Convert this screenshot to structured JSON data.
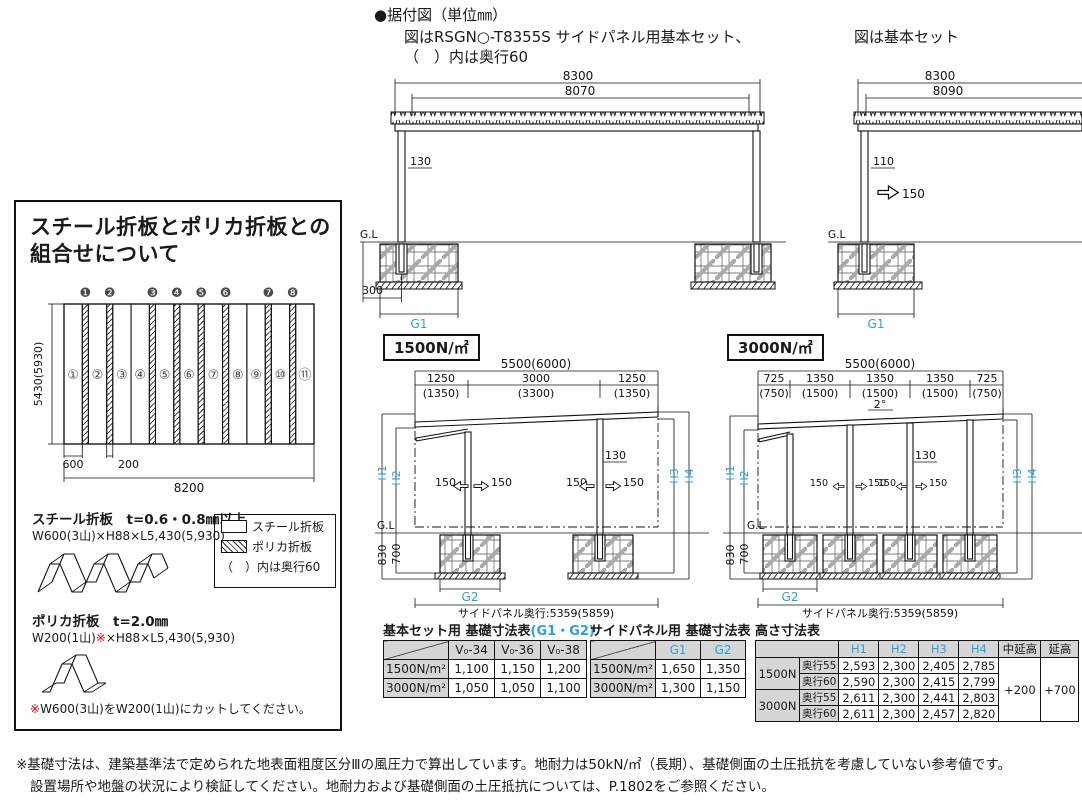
{
  "header": {
    "title": "●据付図（単位㎜）",
    "caption1a": "図はRSGN○-T8355S サイドパネル用基本セット、",
    "caption1b": "（　）内は奥行60",
    "caption2": "図は基本セット"
  },
  "combo": {
    "title1": "スチール折板とポリカ折板との",
    "title2": "組合せについて",
    "dim_height": "5430(5930)",
    "dim_600": "600",
    "dim_200": "200",
    "dim_8200": "8200",
    "steel_nums": [
      "①",
      "②",
      "③",
      "④",
      "⑤",
      "⑥",
      "⑦",
      "⑧",
      "⑨",
      "⑩",
      "⑪"
    ],
    "poly_nums": [
      "❶",
      "❷",
      "❸",
      "❹",
      "❺",
      "❻",
      "❼",
      "❽"
    ],
    "steel_title": "スチール折板　t=0.6・0.8㎜以上",
    "steel_spec": "W600(3山)×H88×L5,430(5,930)",
    "poly_title": "ポリカ折板　t=2.0㎜",
    "poly_spec_pre": "W200(1山)",
    "poly_spec_mark": "※",
    "poly_spec_post": "×H88×L5,430(5,930)",
    "legend_steel": "スチール折板",
    "legend_poly": "ポリカ折板",
    "legend_note": "（　）内は奥行60",
    "cut_mark": "※",
    "cut_note": "W600(3山)をW200(1山)にカットしてください。"
  },
  "elev_sp": {
    "dim_total": "8300",
    "dim_roof": "8070",
    "dim_gap": "130",
    "gl": "G.L",
    "dim_offset": "300",
    "g1": "G1"
  },
  "elev_basic": {
    "dim_total": "8300",
    "dim_roof": "8090",
    "dim_gap": "110",
    "wind": "150",
    "gl": "G.L",
    "g1": "G1"
  },
  "sec1500": {
    "badge": "1500N/㎡",
    "dim_total": "5500(6000)",
    "seg": [
      "1250",
      "3000",
      "1250"
    ],
    "seg_paren": [
      "(1350)",
      "(3300)",
      "(1350)"
    ],
    "h1": "H1",
    "h2": "H2",
    "h3": "H3",
    "h4": "H4",
    "d830": "830",
    "d700": "700",
    "gl": "G.L",
    "a": "150",
    "d130": "130",
    "g2": "G2",
    "depth": "サイドパネル奥行:5359(5859)"
  },
  "sec3000": {
    "badge": "3000N/㎡",
    "dim_total": "5500(6000)",
    "seg": [
      "725",
      "1350",
      "1350",
      "1350",
      "725"
    ],
    "seg_paren": [
      "(750)",
      "(1500)",
      "(1500)",
      "(1500)",
      "(750)"
    ],
    "angle": "2°",
    "h1": "H1",
    "h2": "H2",
    "h3": "H3",
    "h4": "H4",
    "d830": "830",
    "d700": "700",
    "gl": "G.L",
    "a": "150",
    "d130": "130",
    "g2": "G2",
    "depth": "サイドパネル奥行:5359(5859)"
  },
  "tables": {
    "basic": {
      "title": "基本セット用 基礎寸法表",
      "title_sub": "(G1・G2)",
      "cols": [
        "V₀-34",
        "V₀-36",
        "V₀-38"
      ],
      "rows": [
        {
          "label": "1500N/m²",
          "values": [
            "1,100",
            "1,150",
            "1,200"
          ]
        },
        {
          "label": "3000N/m²",
          "values": [
            "1,050",
            "1,050",
            "1,100"
          ]
        }
      ]
    },
    "side": {
      "title": "サイドパネル用 基礎寸法表",
      "cols": [
        "G1",
        "G2"
      ],
      "rows": [
        {
          "label": "1500N/m²",
          "values": [
            "1,650",
            "1,350"
          ]
        },
        {
          "label": "3000N/m²",
          "values": [
            "1,300",
            "1,150"
          ]
        }
      ]
    },
    "height": {
      "title": "高さ寸法表",
      "cols": [
        "H1",
        "H2",
        "H3",
        "H4",
        "中延高",
        "延高"
      ],
      "groups": [
        {
          "label": "1500N",
          "rows": [
            {
              "sub": "奥行55",
              "values": [
                "2,593",
                "2,300",
                "2,405",
                "2,785"
              ]
            },
            {
              "sub": "奥行60",
              "values": [
                "2,590",
                "2,300",
                "2,415",
                "2,799"
              ]
            }
          ]
        },
        {
          "label": "3000N",
          "rows": [
            {
              "sub": "奥行55",
              "values": [
                "2,611",
                "2,300",
                "2,441",
                "2,803"
              ]
            },
            {
              "sub": "奥行60",
              "values": [
                "2,611",
                "2,300",
                "2,457",
                "2,820"
              ]
            }
          ]
        }
      ],
      "mid_ext": "+200",
      "ext": "+700"
    }
  },
  "footnote": {
    "line1": "※基礎寸法は、建築基準法で定められた地表面粗度区分Ⅲの風圧力で算出しています。地耐力は50kN/㎡（長期）、基礎側面の土圧抵抗を考慮していない参考値です。",
    "line2": "設置場所や地盤の状況により検証してください。地耐力および基礎側面の土圧抵抗については、P.1802をご参照ください。"
  },
  "colors": {
    "accent_blue": "#2b9fd9",
    "note_red": "#e50012",
    "table_header_bg": "#d6d6d6"
  }
}
